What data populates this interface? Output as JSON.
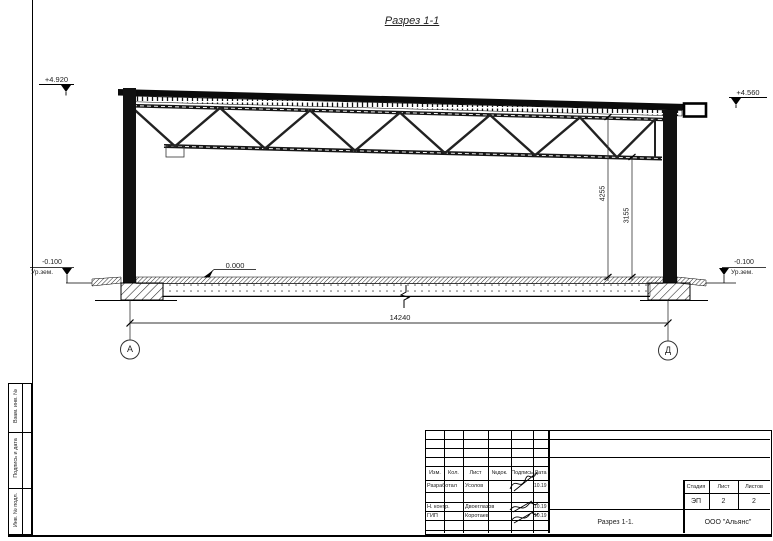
{
  "title": "Разрез 1-1",
  "drawing": {
    "levels": {
      "top_left": "+4.920",
      "top_right": "+4.560",
      "floor": "0.000",
      "ground_left_value": "-0.100",
      "ground_left_label": "Ур.зем.",
      "ground_right_value": "-0.100",
      "ground_right_label": "Ур.зем."
    },
    "dimensions": {
      "span": "14240",
      "height_to_truss_top": "4255",
      "height_to_truss_bottom": "3155"
    },
    "axes": {
      "left": "А",
      "right": "Д"
    }
  },
  "side_strip": {
    "items": [
      "Взам. инв. №",
      "Подпись и дата",
      "Инв. № подл."
    ]
  },
  "title_block": {
    "header": [
      "Изм.",
      "Кол.",
      "Лист",
      "№док.",
      "Подпись",
      "Дата"
    ],
    "rows": [
      {
        "role": "Разработал",
        "name": "Усолов",
        "date": "10.19"
      },
      {
        "role": "Н. контр.",
        "name": "Двоеглазов",
        "date": "10.19"
      },
      {
        "role": "ГИП",
        "name": "Коротаев",
        "date": "10.19"
      }
    ],
    "stage_label": "Стадия",
    "sheet_label": "Лист",
    "sheets_label": "Листов",
    "stage": "ЭП",
    "sheet": "2",
    "sheets": "2",
    "doc_name": "Разрез 1-1.",
    "company": "ООО \"Альянс\""
  }
}
